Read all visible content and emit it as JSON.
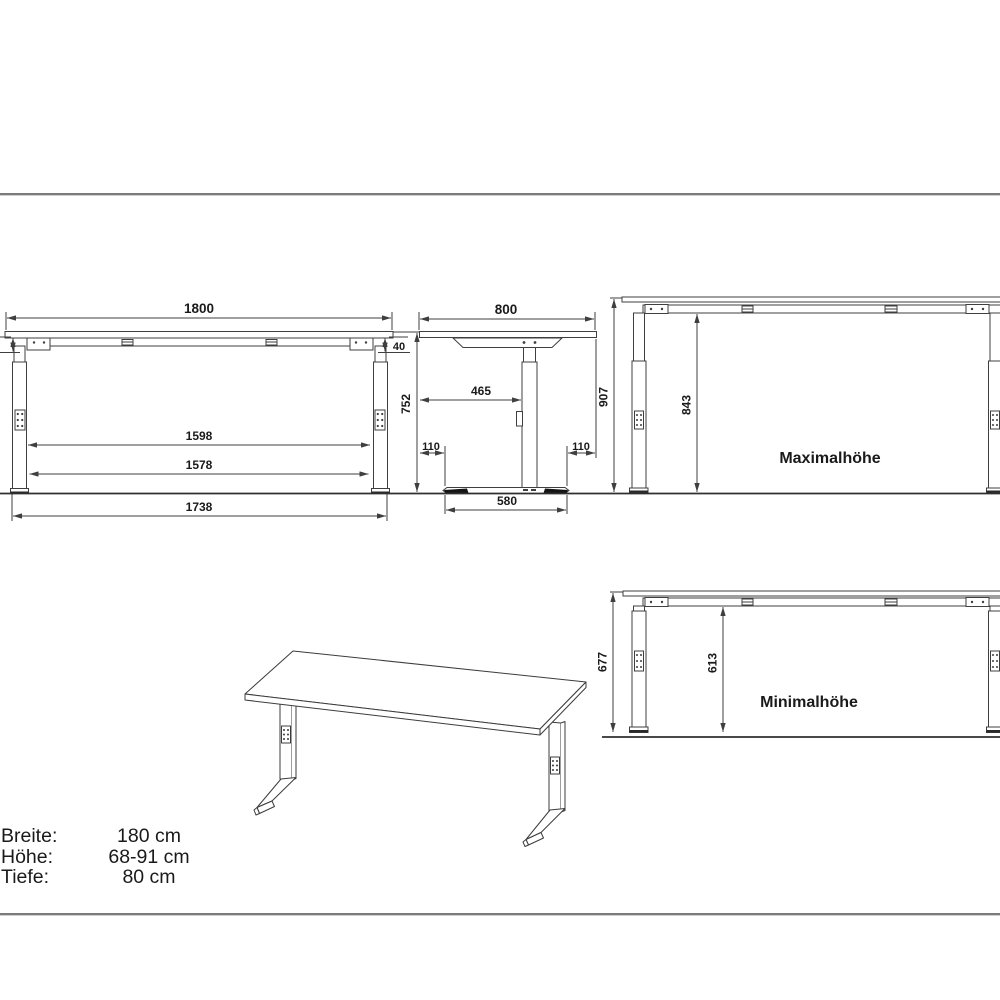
{
  "page": {
    "background": "#ffffff",
    "separator_color": "#7b7b7b",
    "line_color": "#3f3f3f",
    "text_color": "#1a1a1a"
  },
  "front_view": {
    "top_width": "1800",
    "frame_height_left": "40",
    "frame_height_right": "40",
    "height": "752",
    "inner_width_upper": "1598",
    "inner_width_lower": "1578",
    "foot_span": "1738"
  },
  "side_view": {
    "top_depth": "800",
    "column_offset": "465",
    "foot_inset_left": "110",
    "foot_inset_right": "110",
    "foot_length": "580"
  },
  "max_height_view": {
    "label": "Maximalhöhe",
    "total_height": "907",
    "underframe_clearance": "843"
  },
  "min_height_view": {
    "label": "Minimalhöhe",
    "total_height": "677",
    "underframe_clearance": "613"
  },
  "specs": {
    "rows": [
      {
        "label": "Breite:",
        "value": "180 cm"
      },
      {
        "label": "Höhe:",
        "value": "68-91 cm"
      },
      {
        "label": "Tiefe:",
        "value": "80 cm"
      }
    ]
  }
}
